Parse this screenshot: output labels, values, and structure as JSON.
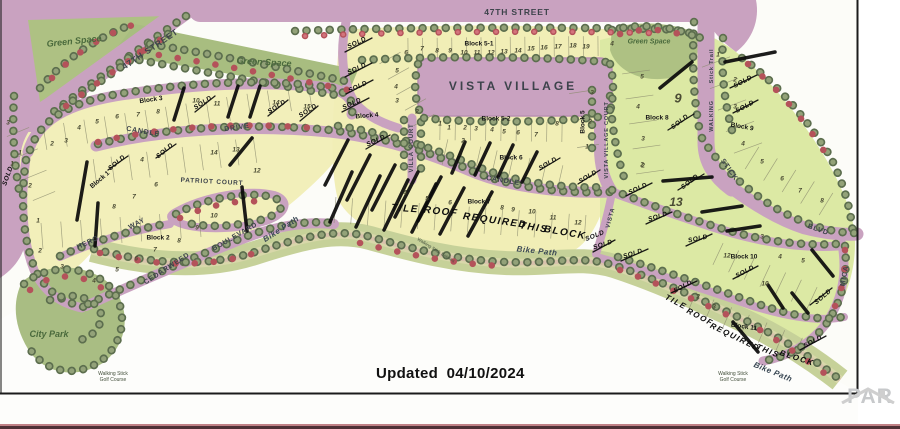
{
  "map": {
    "updated_label": "Updated  04/10/2024",
    "watermark_text": "PAR",
    "labels": {
      "title": {
        "t": "VISTA VILLAGE",
        "x": 513,
        "y": 86,
        "s": 12
      },
      "streets": [
        {
          "t": "47TH STREET",
          "x": 150,
          "y": 49,
          "r": -34,
          "s": 8.5
        },
        {
          "t": "47TH STREET",
          "x": 517,
          "y": 12,
          "r": 0,
          "s": 8.5
        },
        {
          "t": "CANDLE",
          "x": 143,
          "y": 132,
          "r": 10,
          "s": 7
        },
        {
          "t": "DRIVE",
          "x": 237,
          "y": 128,
          "r": -8,
          "s": 7
        },
        {
          "t": "CANDLE",
          "x": 503,
          "y": 181,
          "r": 9,
          "s": 7
        },
        {
          "t": "VILLA COURT",
          "x": 412,
          "y": 148,
          "r": -90,
          "s": 6
        },
        {
          "t": "VISTA VILLAGE COURT",
          "x": 607,
          "y": 140,
          "r": -90,
          "s": 5.5
        },
        {
          "t": "PATRIOT COURT",
          "x": 212,
          "y": 182,
          "r": 3,
          "s": 6.5
        },
        {
          "t": "HERO",
          "x": 88,
          "y": 243,
          "r": -25,
          "s": 7
        },
        {
          "t": "WAY",
          "x": 137,
          "y": 224,
          "r": -28,
          "s": 7
        },
        {
          "t": "CEDARWEED",
          "x": 167,
          "y": 269,
          "r": -33,
          "s": 7
        },
        {
          "t": "BOULEVARD",
          "x": 235,
          "y": 237,
          "r": -30,
          "s": 7
        },
        {
          "t": "Stick Trail",
          "x": 712,
          "y": 66,
          "r": -90,
          "s": 5.5
        },
        {
          "t": "WALKING",
          "x": 712,
          "y": 116,
          "r": -90,
          "s": 5.5
        },
        {
          "t": "STICK",
          "x": 729,
          "y": 170,
          "r": 55,
          "s": 7
        },
        {
          "t": "BLVD",
          "x": 818,
          "y": 230,
          "r": 20,
          "s": 7
        },
        {
          "t": "MICA",
          "x": 845,
          "y": 276,
          "r": -80,
          "s": 7
        },
        {
          "t": "VISTA",
          "x": 611,
          "y": 218,
          "r": -75,
          "s": 6
        }
      ],
      "bike_paths": [
        {
          "t": "Bike Path",
          "x": 281,
          "y": 229,
          "r": -33,
          "s": 8
        },
        {
          "t": "Bike Path",
          "x": 537,
          "y": 251,
          "r": 6,
          "s": 8
        },
        {
          "t": "Bike Path",
          "x": 773,
          "y": 372,
          "r": 22,
          "s": 8
        }
      ],
      "areas": [
        {
          "t": "Green Space",
          "x": 74,
          "y": 41,
          "r": -6,
          "s": 9
        },
        {
          "t": "Green Space",
          "x": 264,
          "y": 62,
          "r": 3,
          "s": 9
        },
        {
          "t": "Green Space",
          "x": 649,
          "y": 42,
          "r": 0,
          "s": 7
        },
        {
          "t": "City Park",
          "x": 49,
          "y": 334,
          "r": 0,
          "s": 9
        }
      ],
      "blocks": [
        {
          "t": "Block 1",
          "x": 100,
          "y": 180,
          "r": -40
        },
        {
          "t": "Block 2",
          "x": 158,
          "y": 238,
          "r": 0
        },
        {
          "t": "Block 3",
          "x": 151,
          "y": 100,
          "r": -8
        },
        {
          "t": "Block 4",
          "x": 367,
          "y": 116,
          "r": -5
        },
        {
          "t": "Block 5",
          "x": 583,
          "y": 122,
          "r": -90
        },
        {
          "t": "Block 5-1",
          "x": 479,
          "y": 44,
          "r": 0
        },
        {
          "t": "Block 5-2",
          "x": 496,
          "y": 119,
          "r": 0
        },
        {
          "t": "Block 6",
          "x": 511,
          "y": 158,
          "r": 0
        },
        {
          "t": "Block 7",
          "x": 479,
          "y": 202,
          "r": 0
        },
        {
          "t": "Block 8",
          "x": 657,
          "y": 118,
          "r": 0
        },
        {
          "t": "Block 9",
          "x": 742,
          "y": 127,
          "r": 10
        },
        {
          "t": "Block 10",
          "x": 744,
          "y": 257,
          "r": 0
        },
        {
          "t": "Block 11",
          "x": 744,
          "y": 327,
          "r": 8
        }
      ],
      "notes": [
        {
          "t": "TILE",
          "x": 405,
          "y": 209,
          "r": 4,
          "s": 10
        },
        {
          "t": "ROOF",
          "x": 441,
          "y": 212,
          "r": 6,
          "s": 10
        },
        {
          "t": "REQUIRED",
          "x": 495,
          "y": 221,
          "r": 8,
          "s": 10
        },
        {
          "t": "THIS",
          "x": 534,
          "y": 228,
          "r": 9,
          "s": 10
        },
        {
          "t": "BLOCK",
          "x": 565,
          "y": 233,
          "r": 10,
          "s": 10
        },
        {
          "t": "TILE",
          "x": 676,
          "y": 302,
          "r": 28,
          "s": 8
        },
        {
          "t": "ROOF",
          "x": 700,
          "y": 317,
          "r": 28,
          "s": 8
        },
        {
          "t": "REQUIRED",
          "x": 735,
          "y": 337,
          "r": 26,
          "s": 8
        },
        {
          "t": "THIS",
          "x": 768,
          "y": 351,
          "r": 22,
          "s": 8
        },
        {
          "t": "BLOCK",
          "x": 797,
          "y": 358,
          "r": 18,
          "s": 8
        }
      ],
      "sold_text": "SOLD",
      "sold_marks": [
        [
          203,
          103,
          -33
        ],
        [
          277,
          107,
          -33
        ],
        [
          308,
          111,
          -33
        ],
        [
          357,
          43,
          -25
        ],
        [
          357,
          69,
          -25
        ],
        [
          358,
          87,
          -25
        ],
        [
          352,
          104,
          -25
        ],
        [
          376,
          141,
          -25
        ],
        [
          117,
          163,
          -40
        ],
        [
          165,
          151,
          -40
        ],
        [
          8,
          176,
          -70
        ],
        [
          548,
          164,
          -30
        ],
        [
          588,
          177,
          -30
        ],
        [
          595,
          236,
          -22
        ],
        [
          680,
          122,
          -38
        ],
        [
          690,
          182,
          -38
        ],
        [
          743,
          82,
          -28
        ],
        [
          745,
          107,
          -28
        ],
        [
          638,
          189,
          -25
        ],
        [
          658,
          217,
          -18
        ],
        [
          633,
          254,
          -18
        ],
        [
          698,
          239,
          -12
        ],
        [
          603,
          245,
          -18
        ],
        [
          745,
          272,
          -28
        ],
        [
          683,
          287,
          -28
        ],
        [
          823,
          297,
          -40
        ],
        [
          813,
          342,
          -28
        ]
      ],
      "big_numbers": [
        [
          "9",
          678,
          98,
          13
        ],
        [
          "13",
          676,
          202,
          12
        ]
      ],
      "lot_numbers": [
        [
          "1",
          20,
          153
        ],
        [
          "2",
          52,
          144
        ],
        [
          "3",
          66,
          141
        ],
        [
          "4",
          79,
          128
        ],
        [
          "5",
          97,
          122
        ],
        [
          "6",
          117,
          117
        ],
        [
          "7",
          138,
          115
        ],
        [
          "8",
          158,
          112
        ],
        [
          "10",
          196,
          101
        ],
        [
          "11",
          217,
          104
        ],
        [
          "14",
          276,
          103
        ],
        [
          "15",
          307,
          107
        ],
        [
          "3",
          8,
          123
        ],
        [
          "1",
          12,
          164
        ],
        [
          "2",
          30,
          186
        ],
        [
          "1",
          38,
          221
        ],
        [
          "2",
          40,
          251
        ],
        [
          "3",
          62,
          267
        ],
        [
          "4",
          94,
          281
        ],
        [
          "5",
          117,
          270
        ],
        [
          "6",
          136,
          259
        ],
        [
          "7",
          155,
          250
        ],
        [
          "8",
          179,
          241
        ],
        [
          "9",
          197,
          228
        ],
        [
          "10",
          214,
          216
        ],
        [
          "4",
          142,
          160
        ],
        [
          "6",
          156,
          185
        ],
        [
          "7",
          134,
          197
        ],
        [
          "8",
          114,
          207
        ],
        [
          "14",
          214,
          153
        ],
        [
          "13",
          236,
          150
        ],
        [
          "12",
          257,
          171
        ],
        [
          "5",
          397,
          71
        ],
        [
          "4",
          396,
          87
        ],
        [
          "3",
          397,
          101
        ],
        [
          "2",
          417,
          112
        ],
        [
          "1",
          440,
          124
        ],
        [
          "6",
          406,
          53
        ],
        [
          "7",
          422,
          49
        ],
        [
          "8",
          437,
          51
        ],
        [
          "9",
          450,
          51
        ],
        [
          "10",
          464,
          53
        ],
        [
          "11",
          477,
          53
        ],
        [
          "12",
          491,
          53
        ],
        [
          "13",
          504,
          52
        ],
        [
          "14",
          518,
          51
        ],
        [
          "15",
          531,
          49
        ],
        [
          "16",
          544,
          48
        ],
        [
          "17",
          558,
          47
        ],
        [
          "18",
          573,
          46
        ],
        [
          "19",
          586,
          47
        ],
        [
          "4",
          612,
          44
        ],
        [
          "1",
          449,
          128
        ],
        [
          "2",
          465,
          128
        ],
        [
          "3",
          476,
          129
        ],
        [
          "4",
          492,
          130
        ],
        [
          "5",
          504,
          132
        ],
        [
          "6",
          518,
          133
        ],
        [
          "7",
          536,
          135
        ],
        [
          "8",
          557,
          124
        ],
        [
          "3",
          592,
          93
        ],
        [
          "2",
          590,
          122
        ],
        [
          "1",
          587,
          147
        ],
        [
          "2",
          463,
          141
        ],
        [
          "4",
          405,
          193
        ],
        [
          "5",
          427,
          199
        ],
        [
          "6",
          450,
          203
        ],
        [
          "8",
          502,
          208
        ],
        [
          "9",
          513,
          210
        ],
        [
          "10",
          532,
          212
        ],
        [
          "11",
          553,
          218
        ],
        [
          "12",
          578,
          223
        ],
        [
          "5",
          642,
          77
        ],
        [
          "4",
          638,
          107
        ],
        [
          "3",
          643,
          139
        ],
        [
          "2",
          643,
          166
        ],
        [
          "2",
          642,
          165
        ],
        [
          "1",
          718,
          55
        ],
        [
          "2",
          735,
          80
        ],
        [
          "3",
          735,
          107
        ],
        [
          "4",
          743,
          144
        ],
        [
          "5",
          762,
          162
        ],
        [
          "6",
          782,
          179
        ],
        [
          "7",
          800,
          191
        ],
        [
          "8",
          822,
          201
        ],
        [
          "12",
          727,
          256
        ],
        [
          "3",
          762,
          237
        ],
        [
          "4",
          780,
          257
        ],
        [
          "5",
          803,
          261
        ],
        [
          "10",
          765,
          284
        ],
        [
          "2",
          698,
          297
        ],
        [
          "3",
          714,
          307
        ]
      ],
      "small_texts": [
        {
          "t": "Walking Stick",
          "x": 113,
          "y": 374,
          "s": 5
        },
        {
          "t": "Golf Course",
          "x": 113,
          "y": 380,
          "s": 5
        },
        {
          "t": "Walking Stick",
          "x": 733,
          "y": 374,
          "s": 5
        },
        {
          "t": "Golf Course",
          "x": 733,
          "y": 380,
          "s": 5
        },
        {
          "t": "Walking Stick Estates",
          "x": 436,
          "y": 250,
          "r": 32,
          "s": 4.5
        }
      ]
    },
    "strikes": [
      [
        174,
        120,
        184,
        88,
        3.5
      ],
      [
        228,
        117,
        238,
        86,
        3.5
      ],
      [
        250,
        117,
        260,
        86,
        3.5
      ],
      [
        87,
        162,
        77,
        220,
        3.5
      ],
      [
        98,
        203,
        95,
        246,
        3.5
      ],
      [
        230,
        165,
        252,
        138,
        3.5
      ],
      [
        242,
        187,
        247,
        231,
        3.5
      ],
      [
        325,
        185,
        348,
        140,
        3.5
      ],
      [
        347,
        200,
        370,
        155,
        3.5
      ],
      [
        372,
        210,
        395,
        165,
        3.5
      ],
      [
        395,
        217,
        418,
        172,
        3.5
      ],
      [
        418,
        221,
        441,
        177,
        3.5
      ],
      [
        452,
        173,
        465,
        142,
        3.5
      ],
      [
        475,
        175,
        490,
        143,
        3.5
      ],
      [
        498,
        177,
        513,
        145,
        3.5
      ],
      [
        522,
        182,
        537,
        152,
        3.5
      ],
      [
        330,
        222,
        352,
        172,
        3.5
      ],
      [
        356,
        227,
        380,
        176,
        3.5
      ],
      [
        384,
        230,
        408,
        180,
        3.5
      ],
      [
        412,
        232,
        436,
        184,
        3.5
      ],
      [
        440,
        234,
        464,
        188,
        3.5
      ],
      [
        468,
        236,
        492,
        192,
        3.5
      ],
      [
        660,
        88,
        692,
        62,
        3.5
      ],
      [
        725,
        62,
        775,
        52,
        3.5
      ],
      [
        663,
        181,
        712,
        177,
        3.5
      ],
      [
        702,
        212,
        742,
        206,
        3.5
      ],
      [
        727,
        231,
        760,
        226,
        3.5
      ],
      [
        768,
        285,
        783,
        308,
        3.5
      ],
      [
        792,
        293,
        808,
        313,
        3.5
      ],
      [
        812,
        250,
        833,
        276,
        3.5
      ],
      [
        733,
        322,
        758,
        352,
        3.5
      ],
      [
        195,
        112,
        215,
        96,
        1.3
      ],
      [
        268,
        116,
        288,
        100,
        1.3
      ],
      [
        300,
        121,
        318,
        106,
        1.3
      ],
      [
        345,
        52,
        372,
        38,
        1.3
      ],
      [
        345,
        77,
        372,
        63,
        1.3
      ],
      [
        346,
        94,
        373,
        80,
        1.3
      ],
      [
        342,
        112,
        369,
        98,
        1.3
      ],
      [
        366,
        149,
        390,
        135,
        1.3
      ],
      [
        108,
        170,
        128,
        156,
        1.3
      ],
      [
        156,
        158,
        176,
        144,
        1.3
      ],
      [
        540,
        170,
        560,
        158,
        1.3
      ],
      [
        578,
        184,
        600,
        170,
        1.3
      ],
      [
        668,
        130,
        694,
        114,
        1.3
      ],
      [
        678,
        190,
        704,
        174,
        1.3
      ],
      [
        733,
        113,
        758,
        100,
        1.3
      ],
      [
        730,
        88,
        757,
        75,
        1.3
      ],
      [
        626,
        196,
        652,
        183,
        1.3
      ],
      [
        646,
        224,
        672,
        212,
        1.3
      ],
      [
        621,
        261,
        648,
        249,
        1.3
      ],
      [
        686,
        246,
        712,
        234,
        1.3
      ],
      [
        593,
        252,
        615,
        240,
        1.3
      ],
      [
        733,
        279,
        758,
        266,
        1.3
      ],
      [
        671,
        293,
        697,
        281,
        1.3
      ],
      [
        810,
        305,
        832,
        288,
        1.3
      ],
      [
        800,
        350,
        826,
        336,
        1.3
      ]
    ],
    "colors": {
      "road": "#c9a2c0",
      "lot_yellow": "#f2efba",
      "lot_pale": "#f1eeb6",
      "lot_green": "#dce9a4",
      "green_space": "#aec183",
      "shore": "#c6d199",
      "sand": "#dcd8ae",
      "bike": "#d8c2ac",
      "tree_green": "#5c6e4e",
      "tree_red": "#b4525a",
      "ink": "#1b1b1b",
      "bottom_bar": "#4f3136"
    }
  }
}
